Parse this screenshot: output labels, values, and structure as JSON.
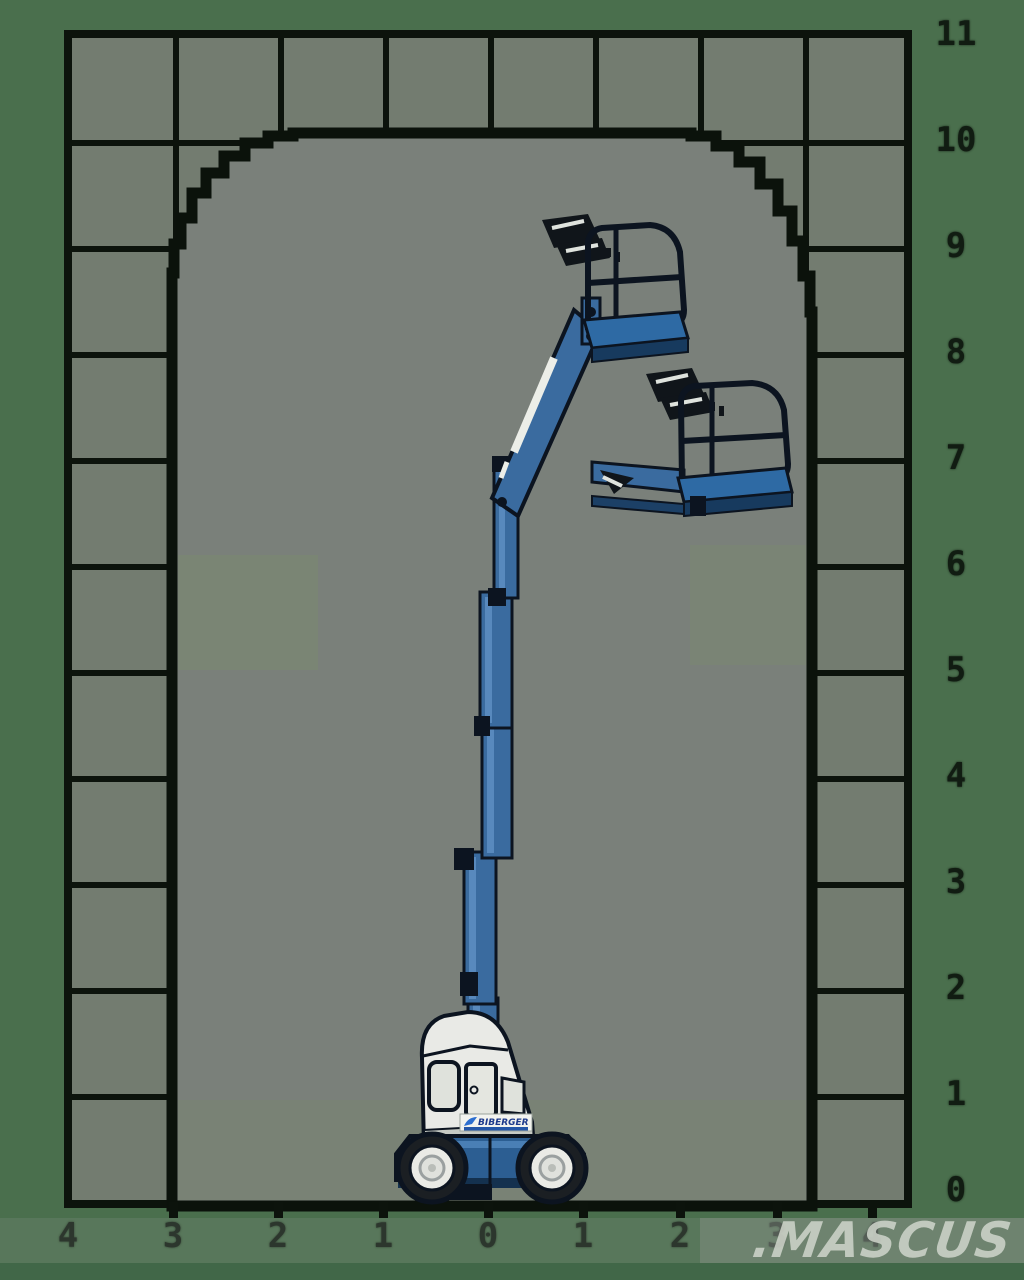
{
  "diagram": {
    "type": "aerial-lift-working-envelope",
    "watermark": ".MASCUS",
    "machine_logo": "BIBERGER"
  },
  "axes": {
    "right_labels": [
      "11",
      "10",
      "9",
      "8",
      "7",
      "6",
      "5",
      "4",
      "3",
      "2",
      "1",
      "0"
    ],
    "bottom_labels": [
      "4",
      "3",
      "2",
      "1",
      "0",
      "1",
      "2",
      "3",
      "4"
    ]
  },
  "colors": {
    "margin_green": "#4a6f4d",
    "grid_line": "#0c130c",
    "cell_fill": "#737c70",
    "envelope_fill": "#7a807a",
    "machine_blue": "#3a6b9f",
    "machine_dark_outline": "#0c1420",
    "body_white": "#e9eae6",
    "logo_blue": "#1d3a8c",
    "watermark_gray": "#cdd3c9"
  },
  "chart_data": {
    "type": "area",
    "title": "",
    "xlabel": "",
    "ylabel": "",
    "x_tick_labels": [
      "4",
      "3",
      "2",
      "1",
      "0",
      "1",
      "2",
      "3",
      "4"
    ],
    "y_tick_labels": [
      "11",
      "10",
      "9",
      "8",
      "7",
      "6",
      "5",
      "4",
      "3",
      "2",
      "1",
      "0"
    ],
    "grid": true,
    "envelope": {
      "description": "reachable working area of vertical-mast boom lift",
      "horizontal_extent_m": [
        -3,
        3
      ],
      "max_height_m": 10,
      "flat_top_from_m": -1.7,
      "flat_top_to_m": 1.7,
      "grid_spacing_m": 1
    }
  }
}
